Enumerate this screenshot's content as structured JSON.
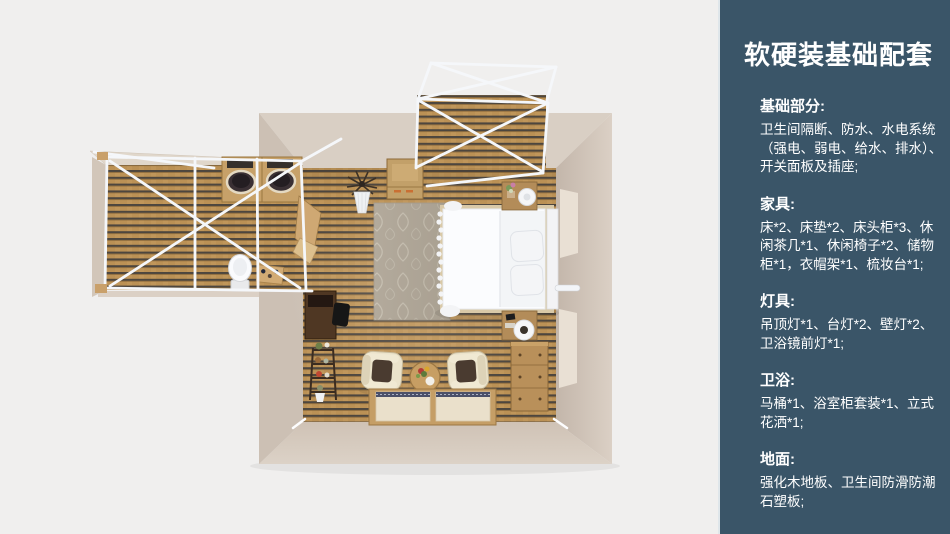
{
  "panel": {
    "title": "软硬装基础配套",
    "bg_color": "#3a5568",
    "text_color": "#ffffff",
    "sections": [
      {
        "id": "basics",
        "heading": "基础部分:",
        "body": "卫生间隔断、防水、水电系统\n（强电、弱电、给水、排水）、\n开关面板及插座;"
      },
      {
        "id": "furniture",
        "heading": "家具:",
        "body": "床*2、床垫*2、床头柜*3、休\n闲茶几*1、休闲椅子*2、储物\n柜*1，衣帽架*1、梳妆台*1;"
      },
      {
        "id": "lighting",
        "heading": "灯具:",
        "body": "吊顶灯*1、台灯*2、壁灯*2、\n卫浴镜前灯*1;"
      },
      {
        "id": "bathroom",
        "heading": "卫浴:",
        "body": "马桶*1、浴室柜套装*1、立式\n花洒*1;"
      },
      {
        "id": "flooring",
        "heading": "地面:",
        "body": "强化木地板、卫生间防滑防潮\n石塑板;"
      }
    ]
  },
  "floorplan": {
    "type": "top-down 3D bedroom render",
    "colors": {
      "background": "#f0efee",
      "wall": "#d5c9bd",
      "wood_floor": "#b98f52",
      "frame_white": "#f5f7fa"
    },
    "items": [
      "terrace-canopy-frame",
      "bathroom-wing",
      "bathroom-vanity",
      "double-sinks",
      "toilet",
      "toiletry-stand",
      "wardrobe-cabinet",
      "potted-plant",
      "area-rug",
      "double-bed",
      "pillows",
      "headboard",
      "bed-canopy-pole",
      "nightstand-top",
      "nightstand-bottom",
      "table-lamps",
      "dresser",
      "vanity-desk",
      "desk-chair",
      "ladder-shelf",
      "armchair-left",
      "armchair-right",
      "round-tea-table",
      "tatami-mats"
    ]
  }
}
